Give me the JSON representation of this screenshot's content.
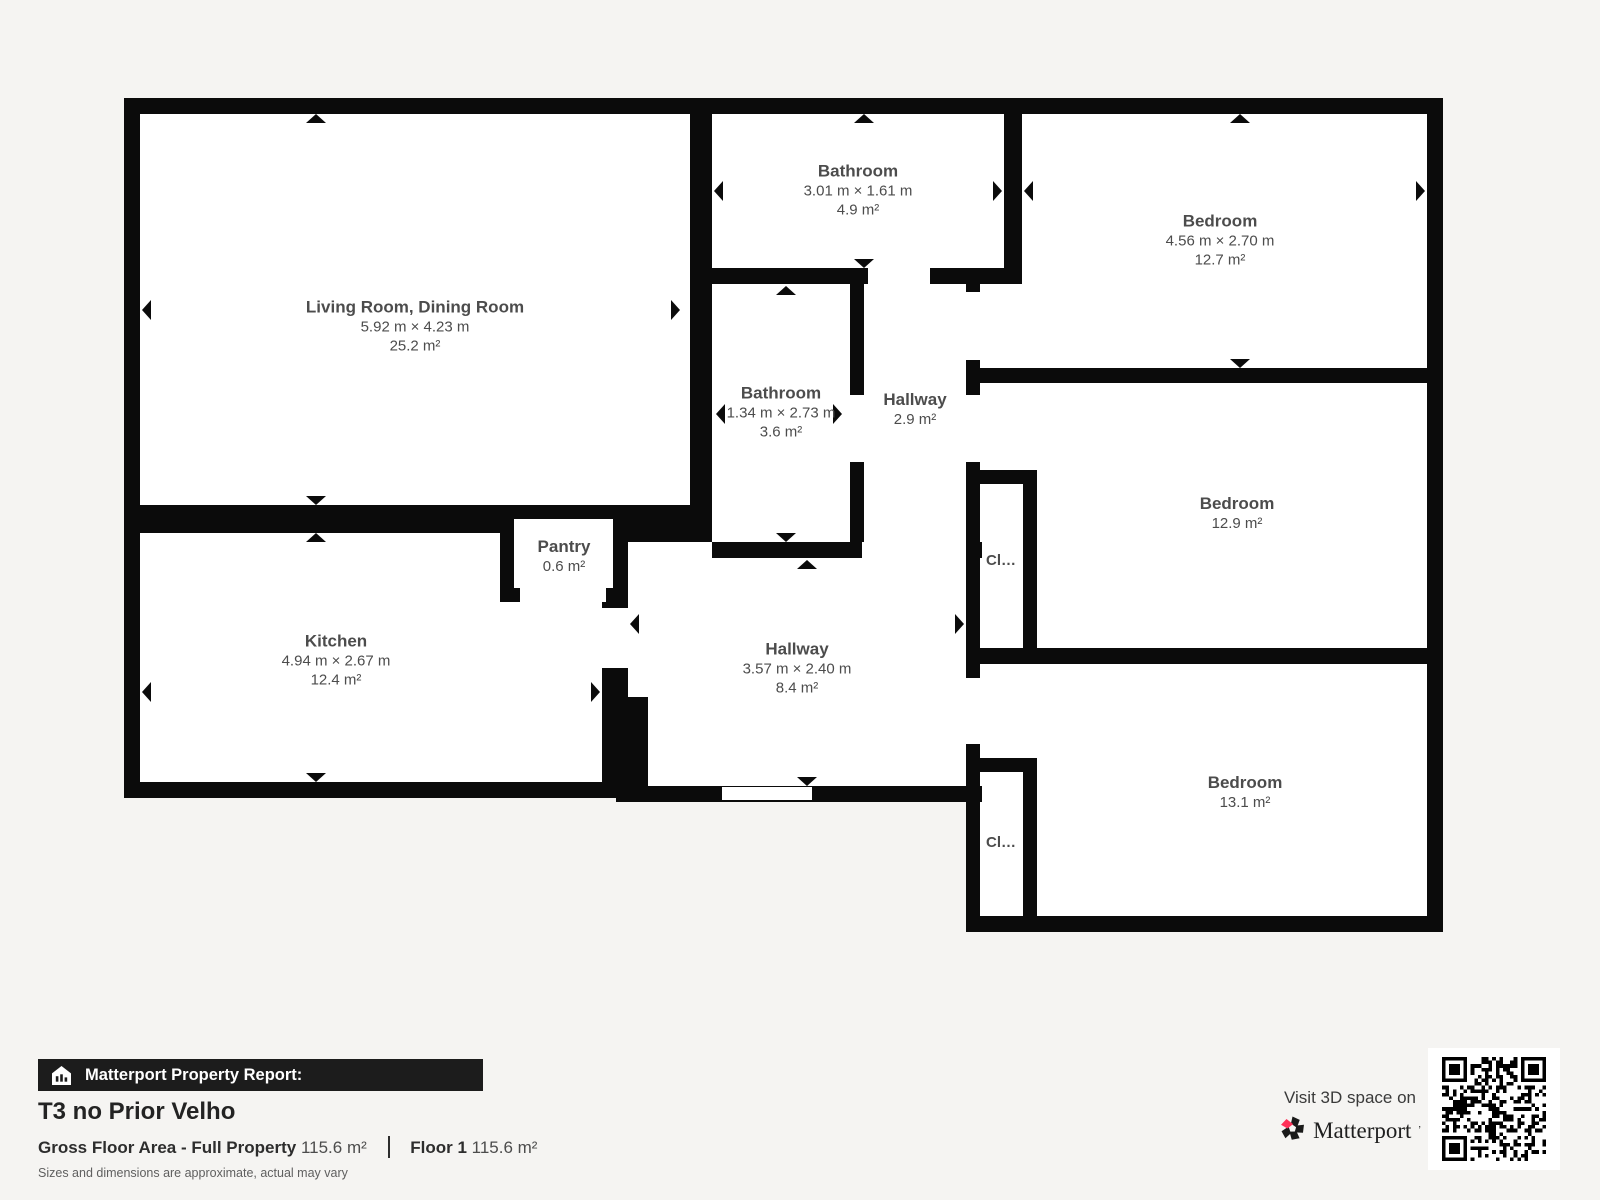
{
  "plan": {
    "rooms": {
      "living": {
        "name": "Living Room, Dining Room",
        "dims": "5.92 m × 4.23 m",
        "area": "25.2 m²"
      },
      "kitchen": {
        "name": "Kitchen",
        "dims": "4.94 m × 2.67 m",
        "area": "12.4 m²"
      },
      "pantry": {
        "name": "Pantry",
        "area": "0.6 m²"
      },
      "bathroom_top": {
        "name": "Bathroom",
        "dims": "3.01 m × 1.61 m",
        "area": "4.9 m²"
      },
      "bathroom_mid": {
        "name": "Bathroom",
        "dims": "1.34 m × 2.73 m",
        "area": "3.6 m²"
      },
      "hallway_small": {
        "name": "Hallway",
        "area": "2.9 m²"
      },
      "hallway_main": {
        "name": "Hallway",
        "dims": "3.57 m × 2.40 m",
        "area": "8.4 m²"
      },
      "bedroom_top": {
        "name": "Bedroom",
        "dims": "4.56 m × 2.70 m",
        "area": "12.7 m²"
      },
      "bedroom_mid": {
        "name": "Bedroom",
        "area": "12.9 m²"
      },
      "bedroom_bottom": {
        "name": "Bedroom",
        "area": "13.1 m²"
      },
      "closet_mid": {
        "label": "Cl…"
      },
      "closet_bottom": {
        "label": "Cl…"
      }
    }
  },
  "footer": {
    "report_label": "Matterport Property Report:",
    "property_title": "T3 no Prior Velho",
    "gross_floor_area_label": "Gross Floor Area - Full Property",
    "gross_floor_area_value": "115.6 m²",
    "floor_label": "Floor 1",
    "floor_value": "115.6 m²",
    "disclaimer": "Sizes and dimensions are approximate, actual may vary",
    "cta_text": "Visit 3D space on",
    "brand_name": "Matterport"
  },
  "colors": {
    "wall": "#0b0b0b",
    "background": "#f5f4f2",
    "floor": "#ffffff",
    "brand_pink": "#ff3158"
  }
}
